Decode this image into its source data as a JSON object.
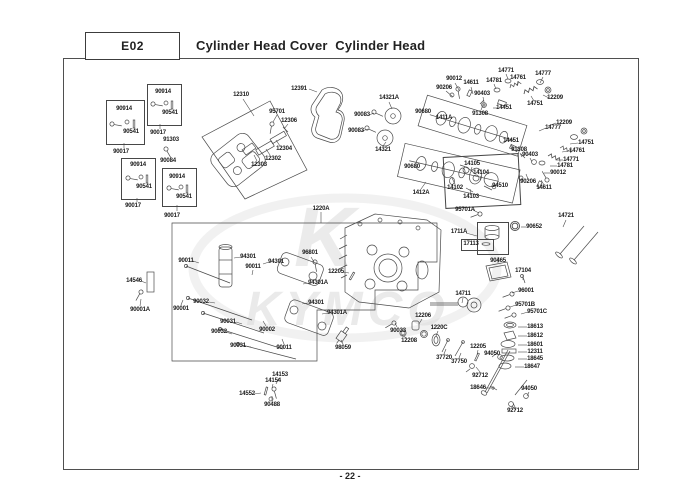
{
  "header": {
    "code": "E02",
    "title": "Cylinder Head Cover  Cylinder Head"
  },
  "footer": {
    "page_label": "- 22 -"
  },
  "watermark": {
    "brand": "KYMCO",
    "initial": "K"
  },
  "diagram": {
    "labels": [
      {
        "t": "90914",
        "x": 124,
        "y": 109
      },
      {
        "t": "90541",
        "x": 131,
        "y": 132
      },
      {
        "t": "90017",
        "x": 121,
        "y": 152
      },
      {
        "t": "90914",
        "x": 163,
        "y": 92
      },
      {
        "t": "90541",
        "x": 170,
        "y": 113
      },
      {
        "t": "90017",
        "x": 158,
        "y": 133
      },
      {
        "t": "91303",
        "x": 171,
        "y": 140
      },
      {
        "t": "90084",
        "x": 168,
        "y": 161
      },
      {
        "t": "90914",
        "x": 138,
        "y": 165
      },
      {
        "t": "90541",
        "x": 144,
        "y": 187
      },
      {
        "t": "90017",
        "x": 133,
        "y": 206
      },
      {
        "t": "90914",
        "x": 177,
        "y": 177
      },
      {
        "t": "90541",
        "x": 184,
        "y": 197
      },
      {
        "t": "90017",
        "x": 172,
        "y": 216
      },
      {
        "t": "12310",
        "x": 241,
        "y": 95
      },
      {
        "t": "12391",
        "x": 299,
        "y": 89
      },
      {
        "t": "95701",
        "x": 277,
        "y": 112
      },
      {
        "t": "12306",
        "x": 289,
        "y": 121
      },
      {
        "t": "12304",
        "x": 284,
        "y": 149
      },
      {
        "t": "12302",
        "x": 273,
        "y": 159
      },
      {
        "t": "12303",
        "x": 259,
        "y": 165
      },
      {
        "t": "14321A",
        "x": 389,
        "y": 98
      },
      {
        "t": "90083",
        "x": 362,
        "y": 115
      },
      {
        "t": "90083",
        "x": 356,
        "y": 131
      },
      {
        "t": "14321",
        "x": 383,
        "y": 150
      },
      {
        "t": "90680",
        "x": 423,
        "y": 112
      },
      {
        "t": "1411A",
        "x": 444,
        "y": 118
      },
      {
        "t": "90680",
        "x": 412,
        "y": 167
      },
      {
        "t": "1412A",
        "x": 421,
        "y": 193
      },
      {
        "t": "14102",
        "x": 455,
        "y": 188
      },
      {
        "t": "90012",
        "x": 454,
        "y": 79
      },
      {
        "t": "90206",
        "x": 444,
        "y": 88
      },
      {
        "t": "14611",
        "x": 471,
        "y": 83
      },
      {
        "t": "90403",
        "x": 482,
        "y": 94
      },
      {
        "t": "91308",
        "x": 480,
        "y": 114
      },
      {
        "t": "14451",
        "x": 504,
        "y": 108
      },
      {
        "t": "14781",
        "x": 494,
        "y": 81
      },
      {
        "t": "14771",
        "x": 506,
        "y": 71
      },
      {
        "t": "14761",
        "x": 518,
        "y": 78
      },
      {
        "t": "14777",
        "x": 543,
        "y": 74
      },
      {
        "t": "12209",
        "x": 555,
        "y": 98
      },
      {
        "t": "14751",
        "x": 535,
        "y": 104
      },
      {
        "t": "12209",
        "x": 564,
        "y": 123
      },
      {
        "t": "14777",
        "x": 553,
        "y": 128
      },
      {
        "t": "14451",
        "x": 511,
        "y": 141
      },
      {
        "t": "91308",
        "x": 519,
        "y": 150
      },
      {
        "t": "90403",
        "x": 530,
        "y": 155
      },
      {
        "t": "14751",
        "x": 586,
        "y": 143
      },
      {
        "t": "14761",
        "x": 577,
        "y": 151
      },
      {
        "t": "14771",
        "x": 571,
        "y": 160
      },
      {
        "t": "14781",
        "x": 565,
        "y": 166
      },
      {
        "t": "90012",
        "x": 558,
        "y": 173
      },
      {
        "t": "90206",
        "x": 528,
        "y": 182
      },
      {
        "t": "14611",
        "x": 544,
        "y": 188
      },
      {
        "t": "14105",
        "x": 472,
        "y": 164
      },
      {
        "t": "14104",
        "x": 481,
        "y": 173
      },
      {
        "t": "94510",
        "x": 500,
        "y": 186
      },
      {
        "t": "14103",
        "x": 471,
        "y": 197
      },
      {
        "t": "95701A",
        "x": 465,
        "y": 210
      },
      {
        "t": "1711A",
        "x": 459,
        "y": 232
      },
      {
        "t": "17113",
        "x": 471,
        "y": 244
      },
      {
        "t": "90652",
        "x": 534,
        "y": 227
      },
      {
        "t": "14721",
        "x": 566,
        "y": 216
      },
      {
        "t": "90465",
        "x": 498,
        "y": 261
      },
      {
        "t": "17104",
        "x": 523,
        "y": 271
      },
      {
        "t": "14711",
        "x": 463,
        "y": 294
      },
      {
        "t": "96001",
        "x": 526,
        "y": 291
      },
      {
        "t": "95701B",
        "x": 525,
        "y": 305
      },
      {
        "t": "95701C",
        "x": 537,
        "y": 312
      },
      {
        "t": "18613",
        "x": 535,
        "y": 327
      },
      {
        "t": "18612",
        "x": 535,
        "y": 336
      },
      {
        "t": "18601",
        "x": 535,
        "y": 345
      },
      {
        "t": "12311",
        "x": 535,
        "y": 352
      },
      {
        "t": "18645",
        "x": 535,
        "y": 359
      },
      {
        "t": "18647",
        "x": 532,
        "y": 367
      },
      {
        "t": "94050",
        "x": 492,
        "y": 354
      },
      {
        "t": "92712",
        "x": 480,
        "y": 376
      },
      {
        "t": "18646",
        "x": 478,
        "y": 388
      },
      {
        "t": "94050",
        "x": 529,
        "y": 389
      },
      {
        "t": "92712",
        "x": 515,
        "y": 411
      },
      {
        "t": "90033",
        "x": 398,
        "y": 331
      },
      {
        "t": "12208",
        "x": 409,
        "y": 341
      },
      {
        "t": "12206",
        "x": 423,
        "y": 316
      },
      {
        "t": "1220C",
        "x": 439,
        "y": 328
      },
      {
        "t": "37720",
        "x": 444,
        "y": 358
      },
      {
        "t": "37750",
        "x": 459,
        "y": 362
      },
      {
        "t": "12205",
        "x": 478,
        "y": 347
      },
      {
        "t": "1220A",
        "x": 321,
        "y": 209
      },
      {
        "t": "90011",
        "x": 186,
        "y": 261
      },
      {
        "t": "94301",
        "x": 248,
        "y": 257
      },
      {
        "t": "90011",
        "x": 253,
        "y": 267
      },
      {
        "t": "94301",
        "x": 276,
        "y": 262
      },
      {
        "t": "96801",
        "x": 310,
        "y": 253
      },
      {
        "t": "12205",
        "x": 336,
        "y": 272
      },
      {
        "t": "94301A",
        "x": 318,
        "y": 283
      },
      {
        "t": "94301",
        "x": 316,
        "y": 303
      },
      {
        "t": "94301A",
        "x": 337,
        "y": 313
      },
      {
        "t": "90032",
        "x": 201,
        "y": 302
      },
      {
        "t": "90001",
        "x": 181,
        "y": 309
      },
      {
        "t": "90031",
        "x": 228,
        "y": 322
      },
      {
        "t": "90032",
        "x": 219,
        "y": 332
      },
      {
        "t": "90002",
        "x": 267,
        "y": 330
      },
      {
        "t": "90031",
        "x": 238,
        "y": 346
      },
      {
        "t": "90011",
        "x": 284,
        "y": 348
      },
      {
        "t": "98059",
        "x": 343,
        "y": 348
      },
      {
        "t": "14546",
        "x": 134,
        "y": 281
      },
      {
        "t": "90001A",
        "x": 140,
        "y": 310
      },
      {
        "t": "14153",
        "x": 280,
        "y": 375
      },
      {
        "t": "14154",
        "x": 273,
        "y": 381
      },
      {
        "t": "14552",
        "x": 247,
        "y": 394
      },
      {
        "t": "90488",
        "x": 272,
        "y": 405
      }
    ],
    "group_boxes": [
      {
        "x": 106,
        "y": 100,
        "w": 37,
        "h": 43,
        "rot": 0
      },
      {
        "x": 147,
        "y": 84,
        "w": 33,
        "h": 40,
        "rot": 0
      },
      {
        "x": 121,
        "y": 158,
        "w": 33,
        "h": 40,
        "rot": 0
      },
      {
        "x": 162,
        "y": 168,
        "w": 33,
        "h": 37,
        "rot": 0
      },
      {
        "x": 444,
        "y": 155,
        "w": 74,
        "h": 50,
        "rot": -3
      },
      {
        "x": 477,
        "y": 222,
        "w": 30,
        "h": 31,
        "rot": 0
      },
      {
        "x": 461,
        "y": 239,
        "w": 31,
        "h": 10,
        "rot": 0
      }
    ]
  }
}
